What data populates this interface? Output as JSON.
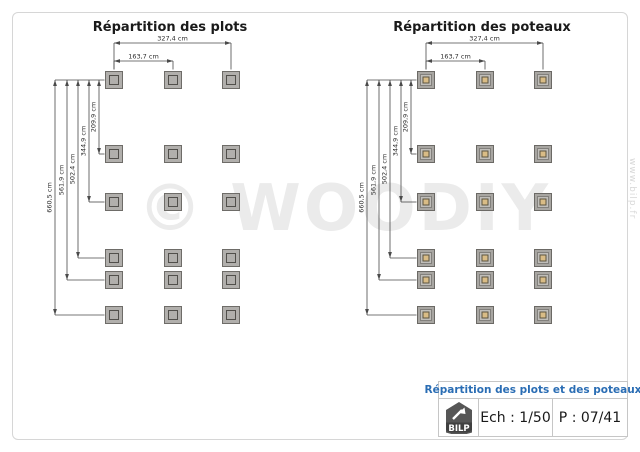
{
  "watermark": {
    "text": "© WOODIY",
    "url_text": "www.bilp.fr"
  },
  "diagrams": [
    {
      "title": "Répartition des plots",
      "marker": "plot",
      "grid": {
        "cols": 3,
        "rows": 6
      },
      "h_dims": [
        {
          "label": "327,4 cm",
          "from_col": 0,
          "to_col": 2,
          "level": 0
        },
        {
          "label": "163,7 cm",
          "from_col": 0,
          "to_col": 1,
          "level": 1
        }
      ],
      "v_dims": [
        {
          "label": "660,5 cm",
          "to_row": 5
        },
        {
          "label": "561,9 cm",
          "to_row": 4
        },
        {
          "label": "502,4 cm",
          "to_row": 3
        },
        {
          "label": "344,9 cm",
          "to_row": 2
        },
        {
          "label": "209,9 cm",
          "to_row": 1
        }
      ]
    },
    {
      "title": "Répartition des poteaux",
      "marker": "post",
      "grid": {
        "cols": 3,
        "rows": 6
      },
      "h_dims": [
        {
          "label": "327,4 cm",
          "from_col": 0,
          "to_col": 2,
          "level": 0
        },
        {
          "label": "163,7 cm",
          "from_col": 0,
          "to_col": 1,
          "level": 1
        }
      ],
      "v_dims": [
        {
          "label": "660,5 cm",
          "to_row": 5
        },
        {
          "label": "561,9 cm",
          "to_row": 4
        },
        {
          "label": "502,4 cm",
          "to_row": 3
        },
        {
          "label": "344,9 cm",
          "to_row": 2
        },
        {
          "label": "209,9 cm",
          "to_row": 1
        }
      ]
    }
  ],
  "title_block": {
    "title": "Répartition des plots et des poteaux",
    "logo_text": "BILP",
    "scale_label": "Ech : 1/50",
    "page_label": "P : 07/41"
  },
  "colors": {
    "accent_blue": "#2a6db4",
    "dim_line": "#4a4a4a",
    "dim_text": "#2e2e2e",
    "plot_outer_fill": "#b1afac",
    "plot_outer_stroke": "#6e6c68",
    "plot_inner_stroke": "#514f4b",
    "post_outer_fill": "#a8a6a2",
    "post_outer_stroke": "#6b6965",
    "post_mid_fill": "#c0beba",
    "post_mid_stroke": "#82807c",
    "post_core_fill": "#d9bc86",
    "post_core_stroke": "#5c5440",
    "watermark_gray": "#ebebeb",
    "logo_gray": "#565656"
  }
}
